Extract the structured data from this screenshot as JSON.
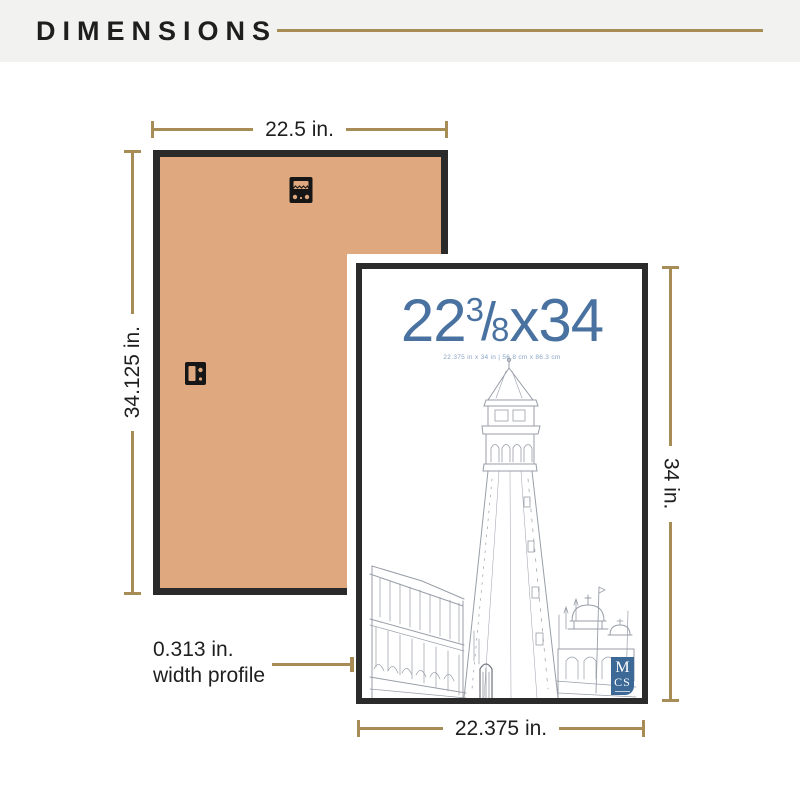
{
  "header": {
    "title": "DIMENSIONS"
  },
  "back_frame": {
    "width_label": "22.5 in.",
    "height_label": "34.125 in."
  },
  "front_frame": {
    "title": {
      "whole": "22",
      "numerator": "3",
      "slash": "/",
      "denominator": "8",
      "suffix": "x34"
    },
    "subtitle": "22.375 in x 34 in | 56.8 cm x 86.3 cm",
    "height_label": "34 in.",
    "width_label": "22.375 in.",
    "logo": {
      "top": "M",
      "bottom": "CS"
    }
  },
  "width_profile": {
    "line1": "0.313 in.",
    "line2": "width profile"
  },
  "colors": {
    "gold": "#a78c55",
    "frame_black": "#2a2a2a",
    "kraft_back": "#dfa87e",
    "title_blue": "#4a72a0",
    "logo_blue": "#3c6995",
    "header_bg": "#f2f2f0",
    "text": "#1f1f1f",
    "sketch_stroke": "#989ea8"
  }
}
